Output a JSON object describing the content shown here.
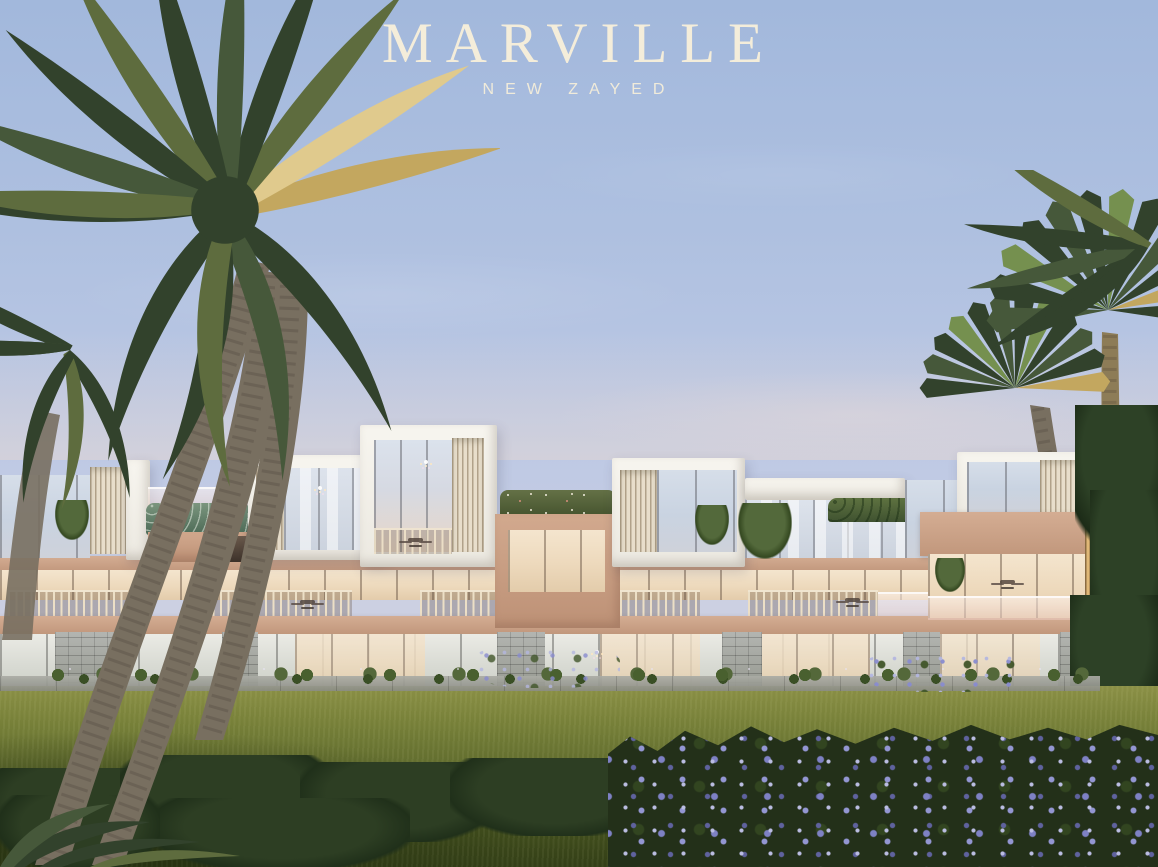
{
  "logo": {
    "title": "MARVILLE",
    "subtitle": "NEW ZAYED"
  },
  "palette": {
    "sky_top": "#a2b8dc",
    "sky_mid": "#bcc8e4",
    "sky_horizon": "#d8d4de",
    "logo_cream": "#f4edda",
    "white_volume": "#ece9e1",
    "beige": "#bd9176",
    "beige_dark": "#c1977c",
    "louver_light": "#e8decb",
    "louver_dark": "#b1a28a",
    "stone_light": "#b3b5b1",
    "stone_dark": "#95988f",
    "hedge_green": "#3f5230",
    "lawn_sun": "#8b9046",
    "lawn_mid": "#5f6b2d",
    "lawn_dark": "#333f17",
    "bush_dark": "#20301a",
    "tree_dark": "#1c2b17",
    "palm_dark": "#32422c",
    "palm_olive": "#5e6c3e",
    "palm_gold": "#c3a75f",
    "trunk": "#786f60",
    "flower_purple": "#9396d2",
    "foliage_bed": "#233019"
  }
}
